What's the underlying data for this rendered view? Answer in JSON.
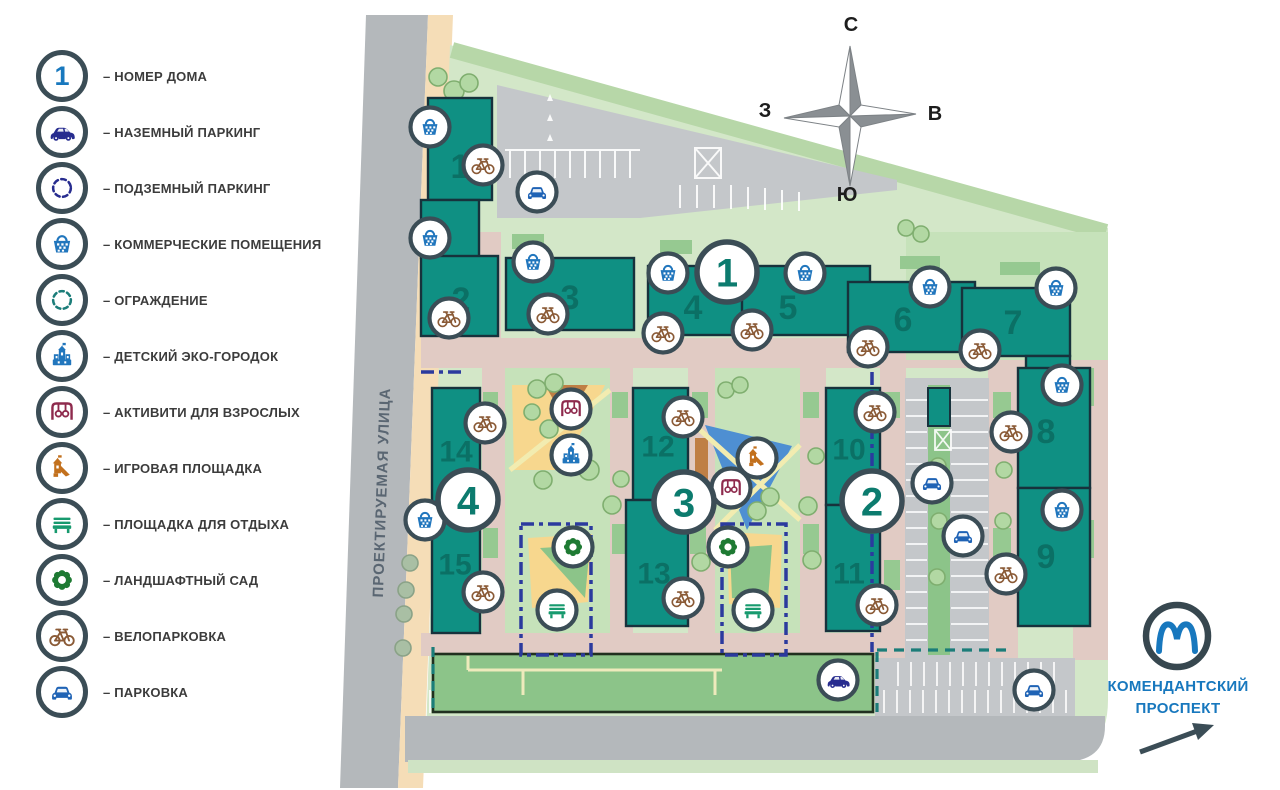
{
  "legend": {
    "prefix": "–",
    "items": [
      {
        "type": "house-number",
        "number": "1",
        "label": "НОМЕР ДОМА"
      },
      {
        "type": "car-side",
        "label": "НАЗЕМНЫЙ ПАРКИНГ"
      },
      {
        "type": "underground",
        "label": "ПОДЗЕМНЫЙ ПАРКИНГ"
      },
      {
        "type": "commercial",
        "label": "КОММЕРЧЕСКИЕ ПОМЕЩЕНИЯ"
      },
      {
        "type": "fence",
        "label": "ОГРАЖДЕНИЕ"
      },
      {
        "type": "eco-town",
        "label": "ДЕТСКИЙ ЭКО-ГОРОДОК"
      },
      {
        "type": "activity",
        "label": "АКТИВИТИ ДЛЯ ВЗРОСЛЫХ"
      },
      {
        "type": "playground",
        "label": "ИГРОВАЯ ПЛОЩАДКА"
      },
      {
        "type": "bench",
        "label": "ПЛОЩАДКА ДЛЯ ОТДЫХА"
      },
      {
        "type": "garden",
        "label": "ЛАНДШАФТНЫЙ САД"
      },
      {
        "type": "bike",
        "label": "ВЕЛОПАРКОВКА"
      },
      {
        "type": "car-front",
        "label": "ПАРКОВКА"
      }
    ]
  },
  "compass": {
    "north": "С",
    "east": "В",
    "south": "Ю",
    "west": "З"
  },
  "map": {
    "street_label": "ПРОЕКТИРУЕМАЯ УЛИЦА",
    "building_labels": [
      {
        "n": "1",
        "x": 460,
        "y": 166
      },
      {
        "n": "2",
        "x": 461,
        "y": 299
      },
      {
        "n": "3",
        "x": 570,
        "y": 297
      },
      {
        "n": "4",
        "x": 693,
        "y": 307
      },
      {
        "n": "5",
        "x": 788,
        "y": 307
      },
      {
        "n": "6",
        "x": 903,
        "y": 319
      },
      {
        "n": "7",
        "x": 1013,
        "y": 322
      },
      {
        "n": "8",
        "x": 1046,
        "y": 431
      },
      {
        "n": "9",
        "x": 1046,
        "y": 556
      },
      {
        "n": "10",
        "x": 849,
        "y": 449
      },
      {
        "n": "11",
        "x": 849,
        "y": 573
      },
      {
        "n": "12",
        "x": 658,
        "y": 446
      },
      {
        "n": "13",
        "x": 654,
        "y": 573
      },
      {
        "n": "14",
        "x": 456,
        "y": 451
      },
      {
        "n": "15",
        "x": 455,
        "y": 564
      }
    ],
    "phase_markers": [
      {
        "n": "1",
        "x": 727,
        "y": 272
      },
      {
        "n": "2",
        "x": 872,
        "y": 501
      },
      {
        "n": "3",
        "x": 684,
        "y": 502
      },
      {
        "n": "4",
        "x": 468,
        "y": 500
      }
    ],
    "markers": [
      {
        "type": "commercial",
        "x": 430,
        "y": 127
      },
      {
        "type": "commercial",
        "x": 430,
        "y": 238
      },
      {
        "type": "commercial",
        "x": 533,
        "y": 262
      },
      {
        "type": "commercial",
        "x": 668,
        "y": 273
      },
      {
        "type": "commercial",
        "x": 805,
        "y": 273
      },
      {
        "type": "commercial",
        "x": 930,
        "y": 287
      },
      {
        "type": "commercial",
        "x": 1056,
        "y": 288
      },
      {
        "type": "commercial",
        "x": 425,
        "y": 520
      },
      {
        "type": "commercial",
        "x": 1062,
        "y": 385
      },
      {
        "type": "commercial",
        "x": 1062,
        "y": 510
      },
      {
        "type": "bike",
        "x": 483,
        "y": 165
      },
      {
        "type": "bike",
        "x": 449,
        "y": 318
      },
      {
        "type": "bike",
        "x": 548,
        "y": 314
      },
      {
        "type": "bike",
        "x": 663,
        "y": 333
      },
      {
        "type": "bike",
        "x": 752,
        "y": 330
      },
      {
        "type": "bike",
        "x": 868,
        "y": 347
      },
      {
        "type": "bike",
        "x": 980,
        "y": 350
      },
      {
        "type": "bike",
        "x": 485,
        "y": 423
      },
      {
        "type": "bike",
        "x": 483,
        "y": 592
      },
      {
        "type": "bike",
        "x": 683,
        "y": 417
      },
      {
        "type": "bike",
        "x": 683,
        "y": 598
      },
      {
        "type": "bike",
        "x": 875,
        "y": 412
      },
      {
        "type": "bike",
        "x": 877,
        "y": 605
      },
      {
        "type": "bike",
        "x": 1011,
        "y": 432
      },
      {
        "type": "bike",
        "x": 1006,
        "y": 574
      },
      {
        "type": "car-front",
        "x": 537,
        "y": 192
      },
      {
        "type": "car-front",
        "x": 932,
        "y": 483
      },
      {
        "type": "car-front",
        "x": 963,
        "y": 536
      },
      {
        "type": "car-front",
        "x": 1034,
        "y": 690
      },
      {
        "type": "car-side",
        "x": 838,
        "y": 680
      },
      {
        "type": "eco-town",
        "x": 571,
        "y": 455
      },
      {
        "type": "activity",
        "x": 571,
        "y": 409
      },
      {
        "type": "activity",
        "x": 731,
        "y": 488
      },
      {
        "type": "playground",
        "x": 757,
        "y": 458
      },
      {
        "type": "garden",
        "x": 573,
        "y": 547
      },
      {
        "type": "garden",
        "x": 728,
        "y": 547
      },
      {
        "type": "bench",
        "x": 557,
        "y": 610
      },
      {
        "type": "bench",
        "x": 753,
        "y": 610
      }
    ]
  },
  "metro": {
    "line1": "КОМЕНДАНТСКИЙ",
    "line2": "ПРОСПЕКТ"
  },
  "colors": {
    "building": "#0f9083",
    "ring": "#3b4d56",
    "metro_blue": "#1878be",
    "fence_teal": "#1b7d79",
    "underground_navy": "#2b3a9e",
    "number_blue": "#1878be",
    "phase_teal": "#0c7b6e"
  }
}
